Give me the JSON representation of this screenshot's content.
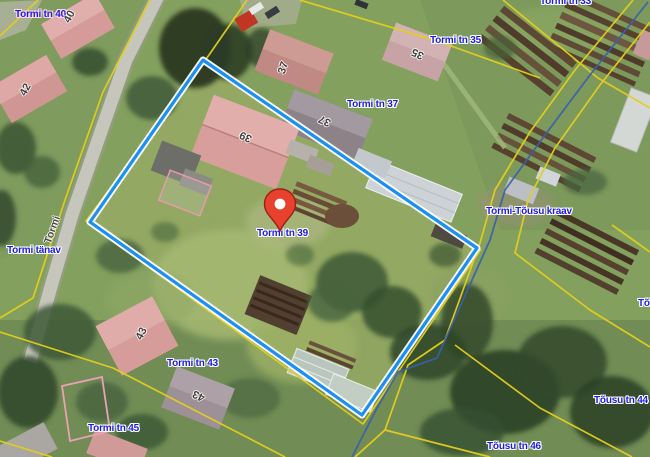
{
  "map": {
    "kind": "aerial-cadastral-map",
    "selected_parcel": "Tormi tn 39",
    "colors": {
      "parcel_boundary": "#1b8ff2",
      "cadastral_line": "#e3cf1d",
      "stream_line": "#3a5fa8",
      "label_text": "#1c1ce0",
      "marker_red": "#e8422e"
    },
    "marker": {
      "icon": "location-pin-icon",
      "label": "Tormi tn 39",
      "x": 280,
      "y": 232
    },
    "labels": [
      {
        "text": "Tormi tn 40",
        "x": 15,
        "y": 9,
        "halo": "#ffd8ea"
      },
      {
        "text": "Tormi tn 33",
        "x": 540,
        "y": -4
      },
      {
        "text": "Tormi tn 35",
        "x": 430,
        "y": 35
      },
      {
        "text": "Tormi tn 37",
        "x": 347,
        "y": 99
      },
      {
        "text": "Tormi-Tõusu kraav",
        "x": 486,
        "y": 206
      },
      {
        "text": "Tormi tn 39",
        "x": 257,
        "y": 228
      },
      {
        "text": "Tormi tänav",
        "x": 7,
        "y": 245
      },
      {
        "text": "Tõ",
        "x": 638,
        "y": 298
      },
      {
        "text": "Tormi tn 43",
        "x": 167,
        "y": 358
      },
      {
        "text": "Tõusu tn 44",
        "x": 594,
        "y": 395
      },
      {
        "text": "Tormi tn 45",
        "x": 88,
        "y": 423
      },
      {
        "text": "Tõusu tn 46",
        "x": 487,
        "y": 441
      }
    ],
    "house_numbers": [
      {
        "text": "40",
        "x": 70,
        "y": 17,
        "rot": -62
      },
      {
        "text": "42",
        "x": 26,
        "y": 90,
        "rot": -62
      },
      {
        "text": "37",
        "x": 284,
        "y": 68,
        "rot": -72
      },
      {
        "text": "35",
        "x": 418,
        "y": 53,
        "rot": 205
      },
      {
        "text": "37",
        "x": 325,
        "y": 120,
        "rot": 205
      },
      {
        "text": "39",
        "x": 246,
        "y": 136,
        "rot": 205
      },
      {
        "text": "43",
        "x": 142,
        "y": 334,
        "rot": -62
      },
      {
        "text": "43",
        "x": 199,
        "y": 395,
        "rot": 205
      }
    ],
    "road_name": {
      "text": "Tormi",
      "x": 53,
      "y": 230,
      "rot": -70
    }
  }
}
